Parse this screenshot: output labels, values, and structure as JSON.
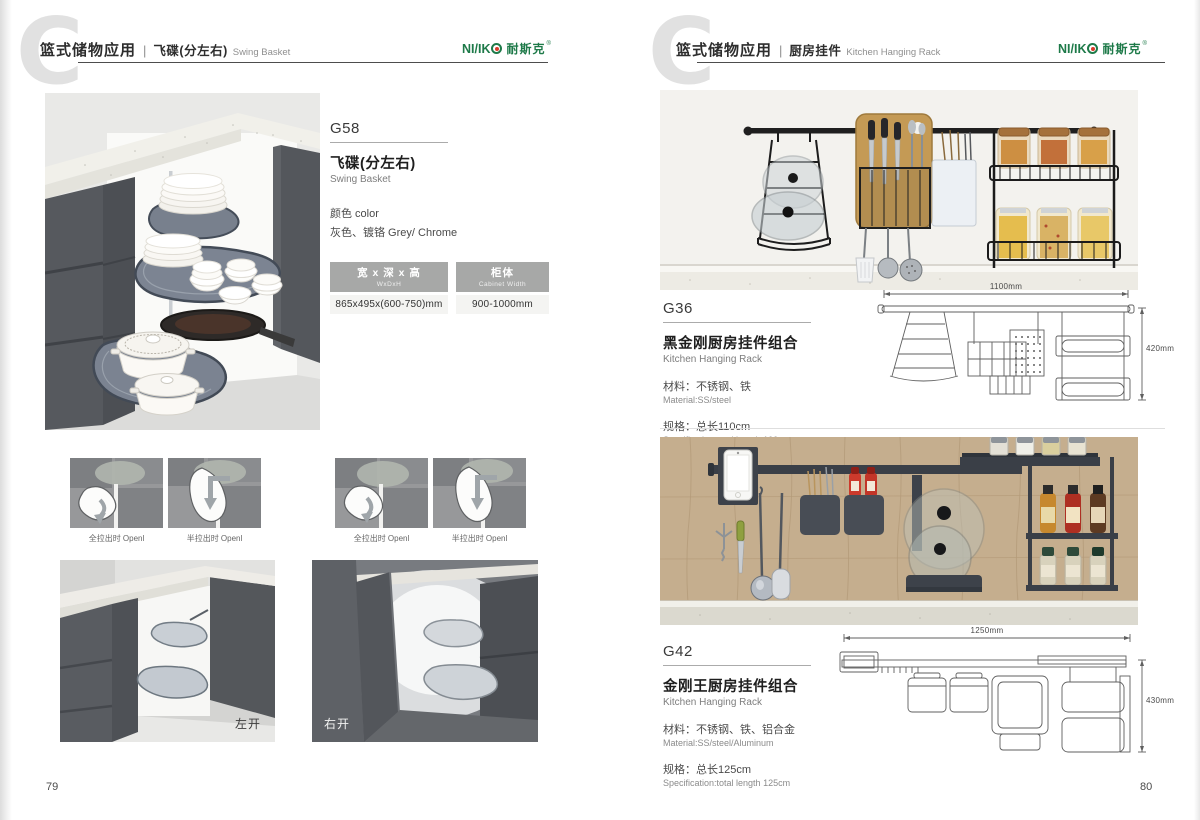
{
  "brand": {
    "logo_latin": "NI/IK",
    "logo_cn": "耐斯克",
    "logo_reg": "®",
    "logo_color": "#1e7a49",
    "logo_dot_color": "#d93a2b"
  },
  "left_page": {
    "page_number": "79",
    "watermark": "C",
    "header": {
      "category": "篮式储物应用",
      "divider": "|",
      "subcategory": "飞碟(分左右)",
      "subcategory_en": "Swing Basket"
    },
    "product": {
      "code": "G58",
      "name_cn": "飞碟(分左右)",
      "name_en": "Swing Basket",
      "color_label": "颜色 color",
      "color_value": "灰色、镀铬 Grey/ Chrome",
      "size_table": {
        "col1_title": "宽 x 深 x 高",
        "col1_sub": "WxDxH",
        "col1_value": "865x495x(600-750)mm",
        "col2_title": "柜体",
        "col2_sub": "Cabinet Width",
        "col2_value": "900-1000mm"
      }
    },
    "diagram_captions": [
      "全拉出时 Openl",
      "半拉出时 Openl",
      "全拉出时 Openl",
      "半拉出时 Openl"
    ],
    "photo_label_left": "左开",
    "photo_label_right": "右开"
  },
  "right_page": {
    "page_number": "80",
    "watermark": "C",
    "header": {
      "category": "篮式储物应用",
      "divider": "|",
      "subcategory": "厨房挂件",
      "subcategory_en": "Kitchen Hanging Rack"
    },
    "products": [
      {
        "code": "G36",
        "name_cn": "黑金刚厨房挂件组合",
        "name_en": "Kitchen Hanging Rack",
        "material_cn": "材料：不锈钢、铁",
        "material_en": "Material:SS/steel",
        "spec_cn": "规格：总长110cm",
        "spec_en": "Specification:total length 100cm",
        "dim_width": "1100mm",
        "dim_height": "420mm"
      },
      {
        "code": "G42",
        "name_cn": "金刚王厨房挂件组合",
        "name_en": "Kitchen Hanging Rack",
        "material_cn": "材料：不锈钢、铁、铝合金",
        "material_en": "Material:SS/steel/Aluminum",
        "spec_cn": "规格：总长125cm",
        "spec_en": "Specification:total length 125cm",
        "dim_width": "1250mm",
        "dim_height": "430mm"
      }
    ]
  }
}
